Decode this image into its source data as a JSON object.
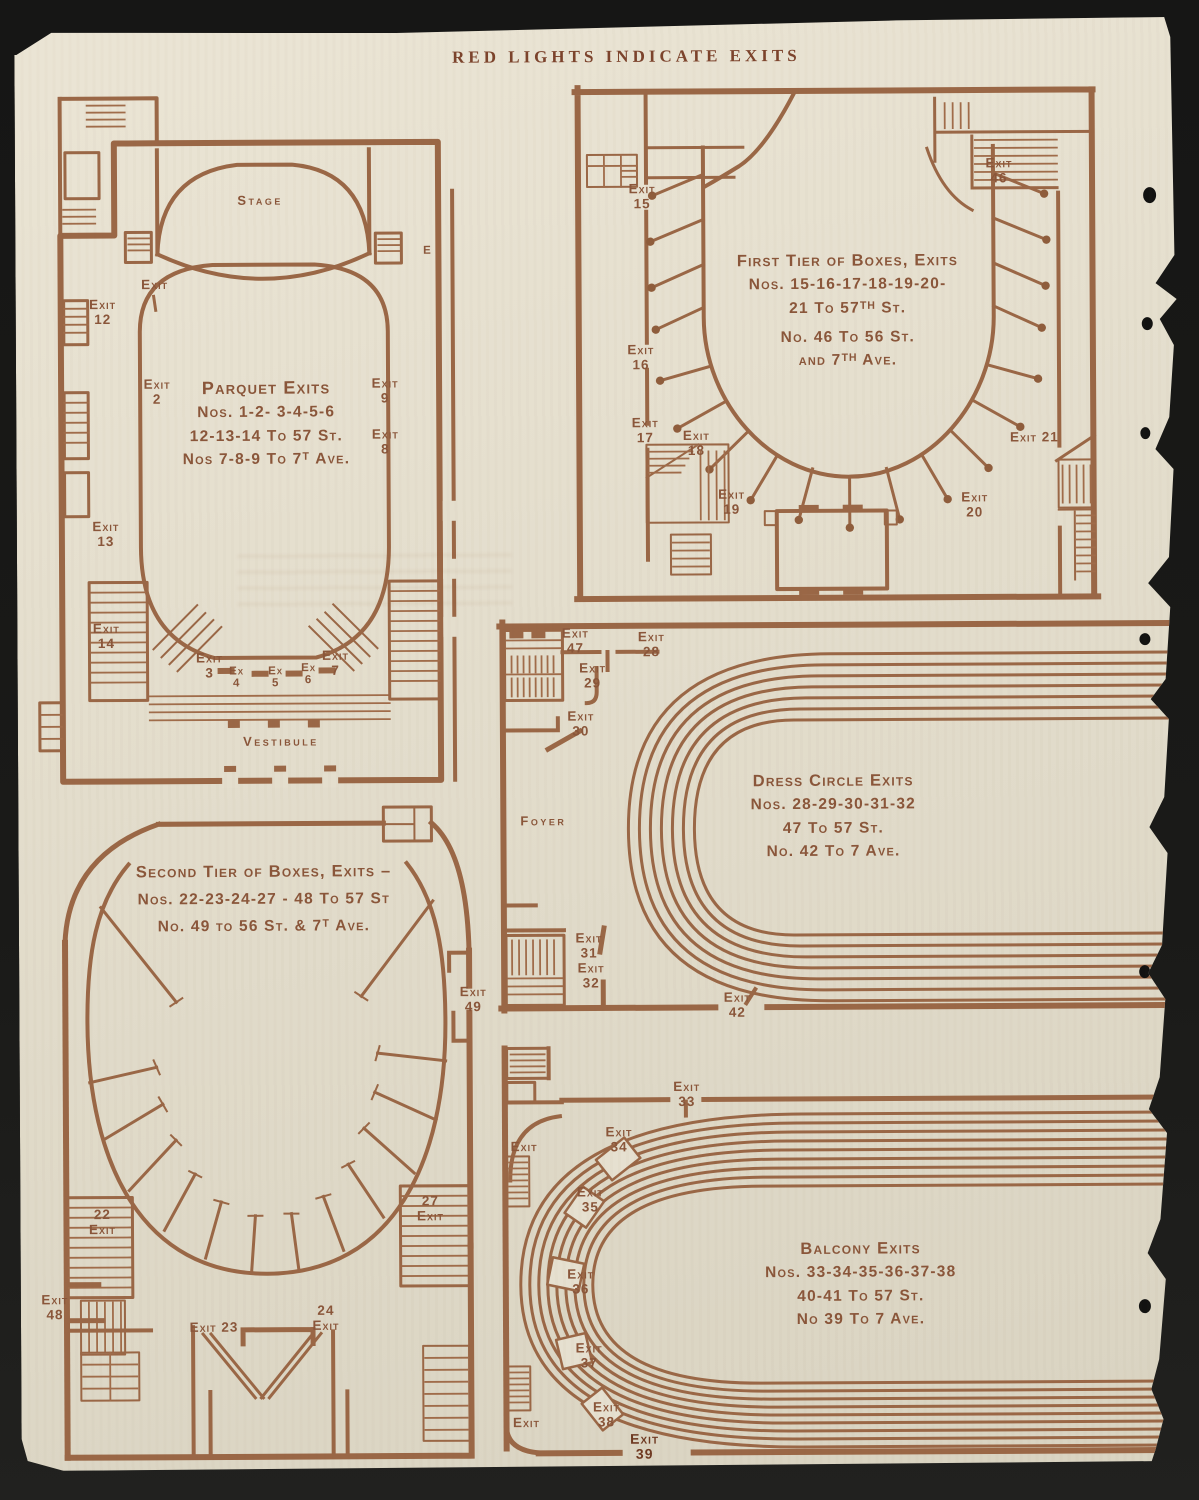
{
  "page_title": "RED LIGHTS INDICATE EXITS",
  "colors": {
    "ink": "#9a6746",
    "paper": "#e4decd",
    "scan_background": "#181816"
  },
  "plans": {
    "parquet": {
      "stage": "Stage",
      "vestibule": "Vestibule",
      "note": [
        "Parquet Exits",
        "Nos. 1-2- 3-4-5-6",
        "12-13-14 To 57 St.",
        "Nos 7-8-9 To 7ᵀ Ave."
      ],
      "exits": {
        "e12": "Exit\n12",
        "e1": "Exit",
        "e2": "Exit\n2",
        "e9": "Exit\n9",
        "e8": "Exit\n8",
        "e13": "Exit\n13",
        "e14": "Exit\n14",
        "e3": "Exit\n3",
        "e4": "Ex\n4",
        "e5": "Ex\n5",
        "e6": "Ex\n6",
        "e7": "Exit\n7",
        "eE": "E"
      }
    },
    "first_tier": {
      "note": [
        "First Tier of Boxes, Exits",
        "Nos. 15-16-17-18-19-20-",
        "21 To 57ᵀᴴ St.",
        "No. 46 To 56 St.",
        "and 7ᵀᴴ Ave."
      ],
      "exits": {
        "e15": "Exit\n15",
        "e16": "Exit\n16",
        "e17": "Exit\n17",
        "e18": "Exit\n18",
        "e19": "Exit\n19",
        "e46": "Exit\n46",
        "e21": "Exit 21",
        "e20": "Exit\n20"
      }
    },
    "dress_circle": {
      "foyer": "Foyer",
      "note": [
        "Dress Circle Exits",
        "Nos. 28-29-30-31-32",
        "47 To 57 St.",
        "No. 42 To 7 Ave."
      ],
      "exits": {
        "e47": "Exit\n47",
        "e28": "Exit\n28",
        "e29": "Exit\n29",
        "e30": "Exit\n30",
        "e31": "Exit\n31",
        "e32": "Exit\n32",
        "e42": "Exit\n42"
      }
    },
    "second_tier": {
      "note": [
        "Second Tier of Boxes, Exits –",
        "Nos. 22-23-24-27 - 48 To 57 St",
        "No. 49 to 56 St. & 7ᵀ Ave."
      ],
      "exits": {
        "e49": "Exit\n49",
        "e22": "22\nExit",
        "e27": "27\nExit",
        "e48": "Exit\n48",
        "e23": "Exit 23",
        "e24": "24\nExit"
      }
    },
    "balcony": {
      "note": [
        "Balcony Exits",
        "Nos. 33-34-35-36-37-38",
        "40-41 To 57 St.",
        "No 39 To 7 Ave."
      ],
      "exits": {
        "e33": "Exit\n33",
        "eL1": "Exit",
        "e34": "Exit\n34",
        "e35": "Exit\n35",
        "e36": "Exit\n36",
        "e37": "Exit\n37",
        "e38": "Exit\n38",
        "eL2": "Exit",
        "e39": "Exit\n39"
      }
    }
  }
}
